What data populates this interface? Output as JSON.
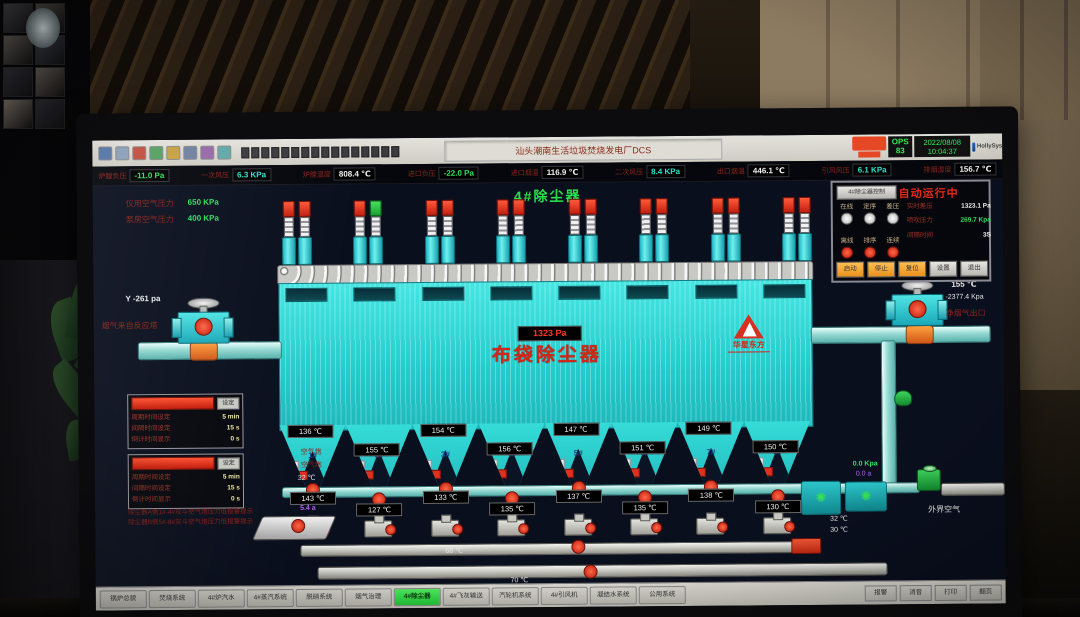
{
  "window": {
    "title": "汕头潮南生活垃圾焚烧发电厂DCS",
    "ops_label": "OPS",
    "ops_value": "83",
    "date": "2022/08/08",
    "time": "10:04:37",
    "brand": "HollySys"
  },
  "toolbar": {
    "icons": [
      "file-icon",
      "save-icon",
      "print-icon",
      "copy-icon",
      "zoom-icon",
      "trend-icon",
      "alarm-icon",
      "setup-icon"
    ],
    "icon_colors": [
      "#5577aa",
      "#8aa0b8",
      "#c05040",
      "#55a060",
      "#c8a040",
      "#7080a0",
      "#9868a8",
      "#60a8a8"
    ],
    "page_button_count": 16
  },
  "status_row": [
    {
      "label": "炉膛负压",
      "value": "-11.0 Pa",
      "color": "#2fe060"
    },
    {
      "label": "一次风压",
      "value": "6.3 KPa",
      "color": "#2de0d0"
    },
    {
      "label": "炉膛温度",
      "value": "808.4 ℃",
      "color": "#efefef"
    },
    {
      "label": "进口负压",
      "value": "-22.0 Pa",
      "color": "#2fe060"
    },
    {
      "label": "进口烟温",
      "value": "116.9 ℃",
      "color": "#efefef"
    },
    {
      "label": "二次风压",
      "value": "8.4 KPa",
      "color": "#2de0d0"
    },
    {
      "label": "出口烟温",
      "value": "446.1 ℃",
      "color": "#efefef"
    },
    {
      "label": "引风风压",
      "value": "6.1 KPa",
      "color": "#2de0d0"
    },
    {
      "label": "排烟温度",
      "value": "156.7 ℃",
      "color": "#efefef"
    }
  ],
  "hmi": {
    "page_title": "4#除尘器",
    "air_supply": [
      {
        "label": "仪用空气压力",
        "value": "650 KPa"
      },
      {
        "label": "泵房空气压力",
        "value": "400 KPa"
      }
    ],
    "inlet": {
      "pressure": "Y -261 pa",
      "label": "烟气来自反应塔"
    },
    "outlet": {
      "temp": "155 ℃",
      "pressure": "-2377.4 Kpa",
      "label": "净烟气出口"
    },
    "vessel": {
      "dp_box": "1323 Pa",
      "name": "布袋除尘器",
      "logo_name": "华星东方"
    },
    "pulse_valves": {
      "pairs": 8,
      "green_cap_index": 3
    },
    "control_panel": {
      "corner_button": "4#除尘器控制",
      "title": "自动运行中",
      "modes_off": [
        "在线",
        "定序",
        "差压"
      ],
      "modes_on": [
        "离线",
        "排序",
        "连续"
      ],
      "readings": [
        {
          "label": "实时差压",
          "value": "1323.1 Pa",
          "color": "#efefef"
        },
        {
          "label": "喷吹压力",
          "value": "269.7 Kpa",
          "color": "#2fe060"
        },
        {
          "label": "间隔时间",
          "value": "3S",
          "color": "#efefef"
        }
      ],
      "buttons": [
        {
          "label": "启动",
          "type": "orange"
        },
        {
          "label": "停止",
          "type": "orange"
        },
        {
          "label": "复位",
          "type": "orange"
        },
        {
          "label": "设置",
          "type": "gray"
        },
        {
          "label": "退出",
          "type": "gray"
        }
      ]
    },
    "timer_panels": [
      {
        "tag": "设定",
        "rows": [
          {
            "label": "周期时间设定",
            "value": "5 min"
          },
          {
            "label": "间隔时间设定",
            "value": "15 s"
          },
          {
            "label": "倒计时间显示",
            "value": "0 s"
          }
        ]
      },
      {
        "tag": "设定",
        "rows": [
          {
            "label": "周期时间设定",
            "value": "5 min"
          },
          {
            "label": "间隔时间设定",
            "value": "15 s"
          },
          {
            "label": "倒计时间显示",
            "value": "0 s"
          }
        ]
      }
    ],
    "alarm_lines": [
      "除尘器A侧1#-4#灰斗空气炮压力低报警提示",
      "除尘器B侧5#-8#灰斗空气炮压力低报警提示"
    ],
    "hoppers": {
      "numbers": [
        "1#",
        "2#",
        "3#",
        "4#",
        "5#",
        "6#",
        "7#",
        "8#"
      ],
      "top_temps": [
        "136 ℃",
        "155 ℃",
        "154 ℃",
        "156 ℃",
        "147 ℃",
        "151 ℃",
        "149 ℃",
        "150 ℃"
      ],
      "discharge_temps": [
        "143 ℃",
        "127 ℃",
        "133 ℃",
        "135 ℃",
        "137 ℃",
        "135 ℃",
        "138 ℃",
        "130 ℃"
      ]
    },
    "blow_pipe": {
      "label1": "空气炮",
      "label2": "空气炮",
      "temp": "32 ℃"
    },
    "conveyors": {
      "temp_upper": "68 ℃",
      "temp_lower": "70 ℃",
      "feeder_current": "5.4 a"
    },
    "right_bottom": {
      "pressure": "0.0 Kpa",
      "current": "0.0 a",
      "temp1": "32 ℃",
      "temp2": "30 ℃",
      "label": "外界空气"
    }
  },
  "tabbar": {
    "tabs": [
      "锅炉总貌",
      "焚烧系统",
      "4#炉汽水",
      "4#蒸汽系统",
      "脱硝系统",
      "烟气治理",
      "4#除尘器",
      "4#飞灰输送",
      "汽轮机系统",
      "4#引风机",
      "凝结水系统",
      "公用系统"
    ],
    "active_index": 6,
    "right_buttons": [
      "报警",
      "消音",
      "打印",
      "翻页"
    ]
  }
}
